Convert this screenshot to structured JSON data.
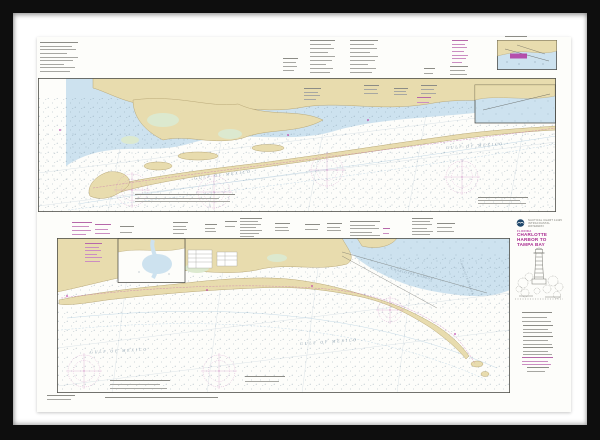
{
  "artwork": {
    "kind": "framed-nautical-chart-print",
    "frame_color": "#0e0e0e",
    "mat_color": "#ffffff",
    "paper_color": "#fdfdfa"
  },
  "title_block": {
    "logo_icon": "noaa-logo",
    "caption_line1": "NAUTICAL CHART 11425",
    "caption_line2": "INTRACOASTAL WATERWAY",
    "region": "FLORIDA",
    "title_line1": "CHARLOTTE",
    "title_line2": "HARBOR TO",
    "title_line3": "TAMPA BAY",
    "title_color": "#a8288f",
    "illustration_icon": "lighthouse-sketch"
  },
  "map_labels": {
    "strip1_gulf_left": "GULF OF MEXICO",
    "strip1_gulf_right": "GULF OF MEXICO",
    "strip2_gulf_left": "GULF OF MEXICO",
    "strip2_gulf_right": "GULF OF MEXICO",
    "strip2_harbor": "CHARLOTTE HARBOR",
    "strip2_harbor_side": "CHARLOTTE HARBOR"
  },
  "palette": {
    "land": "#e8dcae",
    "land_stroke": "#b9a878",
    "shallow_water": "#cde2ef",
    "marsh": "#dce9cf",
    "sounding_dots": "#6b8396",
    "magenta_symbol": "#c246ad",
    "compass_rose": "#d398c9",
    "map_border": "#50504a",
    "sea_label_text": "#8fa3b2"
  },
  "note_blocks": [
    {
      "x": 40,
      "y": 42,
      "w": 38,
      "h": 30,
      "tone": "gray",
      "lines": 9
    },
    {
      "x": 283,
      "y": 58,
      "w": 15,
      "h": 13,
      "tone": "gray",
      "lines": 4
    },
    {
      "x": 310,
      "y": 40,
      "w": 25,
      "h": 33,
      "tone": "gray",
      "lines": 9
    },
    {
      "x": 350,
      "y": 40,
      "w": 28,
      "h": 33,
      "tone": "gray",
      "lines": 9
    },
    {
      "x": 452,
      "y": 40,
      "w": 16,
      "h": 23,
      "tone": "magenta",
      "lines": 7
    },
    {
      "x": 450,
      "y": 66,
      "w": 18,
      "h": 9,
      "tone": "gray",
      "lines": 3
    },
    {
      "x": 424,
      "y": 68,
      "w": 11,
      "h": 6,
      "tone": "gray",
      "lines": 2
    },
    {
      "x": 505,
      "y": 36,
      "w": 22,
      "h": 3,
      "tone": "gray",
      "lines": 1
    },
    {
      "x": 304,
      "y": 88,
      "w": 17,
      "h": 12,
      "tone": "gray",
      "lines": 4
    },
    {
      "x": 364,
      "y": 85,
      "w": 15,
      "h": 9,
      "tone": "gray",
      "lines": 3
    },
    {
      "x": 394,
      "y": 88,
      "w": 14,
      "h": 7,
      "tone": "gray",
      "lines": 3
    },
    {
      "x": 421,
      "y": 85,
      "w": 16,
      "h": 9,
      "tone": "gray",
      "lines": 3
    },
    {
      "x": 417,
      "y": 97,
      "w": 14,
      "h": 6,
      "tone": "magenta",
      "lines": 2
    },
    {
      "x": 135,
      "y": 194,
      "w": 100,
      "h": 8,
      "tone": "gray",
      "lines": 3
    },
    {
      "x": 478,
      "y": 197,
      "w": 50,
      "h": 7,
      "tone": "gray",
      "lines": 3
    },
    {
      "x": 72,
      "y": 222,
      "w": 20,
      "h": 13,
      "tone": "magenta",
      "lines": 4
    },
    {
      "x": 95,
      "y": 224,
      "w": 16,
      "h": 10,
      "tone": "magenta",
      "lines": 3
    },
    {
      "x": 120,
      "y": 226,
      "w": 14,
      "h": 7,
      "tone": "gray",
      "lines": 2
    },
    {
      "x": 173,
      "y": 222,
      "w": 15,
      "h": 12,
      "tone": "gray",
      "lines": 4
    },
    {
      "x": 205,
      "y": 224,
      "w": 12,
      "h": 8,
      "tone": "gray",
      "lines": 3
    },
    {
      "x": 225,
      "y": 221,
      "w": 12,
      "h": 6,
      "tone": "gray",
      "lines": 2
    },
    {
      "x": 240,
      "y": 218,
      "w": 22,
      "h": 19,
      "tone": "gray",
      "lines": 7
    },
    {
      "x": 275,
      "y": 223,
      "w": 15,
      "h": 8,
      "tone": "gray",
      "lines": 3
    },
    {
      "x": 305,
      "y": 224,
      "w": 15,
      "h": 6,
      "tone": "gray",
      "lines": 2
    },
    {
      "x": 327,
      "y": 223,
      "w": 15,
      "h": 8,
      "tone": "gray",
      "lines": 3
    },
    {
      "x": 350,
      "y": 221,
      "w": 30,
      "h": 15,
      "tone": "gray",
      "lines": 5
    },
    {
      "x": 383,
      "y": 228,
      "w": 7,
      "h": 6,
      "tone": "magenta",
      "lines": 2
    },
    {
      "x": 412,
      "y": 218,
      "w": 21,
      "h": 17,
      "tone": "gray",
      "lines": 6
    },
    {
      "x": 437,
      "y": 223,
      "w": 18,
      "h": 9,
      "tone": "gray",
      "lines": 3
    },
    {
      "x": 85,
      "y": 243,
      "w": 17,
      "h": 19,
      "tone": "magenta",
      "lines": 6
    },
    {
      "x": 110,
      "y": 380,
      "w": 60,
      "h": 9,
      "tone": "gray",
      "lines": 3
    },
    {
      "x": 245,
      "y": 376,
      "w": 40,
      "h": 6,
      "tone": "gray",
      "lines": 2
    },
    {
      "x": 522,
      "y": 312,
      "w": 30,
      "h": 10,
      "tone": "gray",
      "lines": 3
    },
    {
      "x": 523,
      "y": 325,
      "w": 30,
      "h": 8,
      "tone": "gray",
      "lines": 3
    },
    {
      "x": 523,
      "y": 336,
      "w": 30,
      "h": 9,
      "tone": "gray",
      "lines": 3
    },
    {
      "x": 523,
      "y": 347,
      "w": 30,
      "h": 8,
      "tone": "gray",
      "lines": 3
    },
    {
      "x": 522,
      "y": 357,
      "w": 31,
      "h": 8,
      "tone": "magenta",
      "lines": 3
    },
    {
      "x": 527,
      "y": 367,
      "w": 22,
      "h": 5,
      "tone": "gray",
      "lines": 2
    },
    {
      "x": 47,
      "y": 395,
      "w": 28,
      "h": 5,
      "tone": "gray",
      "lines": 2
    },
    {
      "x": 105,
      "y": 397,
      "w": 113,
      "h": 2,
      "tone": "gray",
      "lines": 1
    }
  ]
}
